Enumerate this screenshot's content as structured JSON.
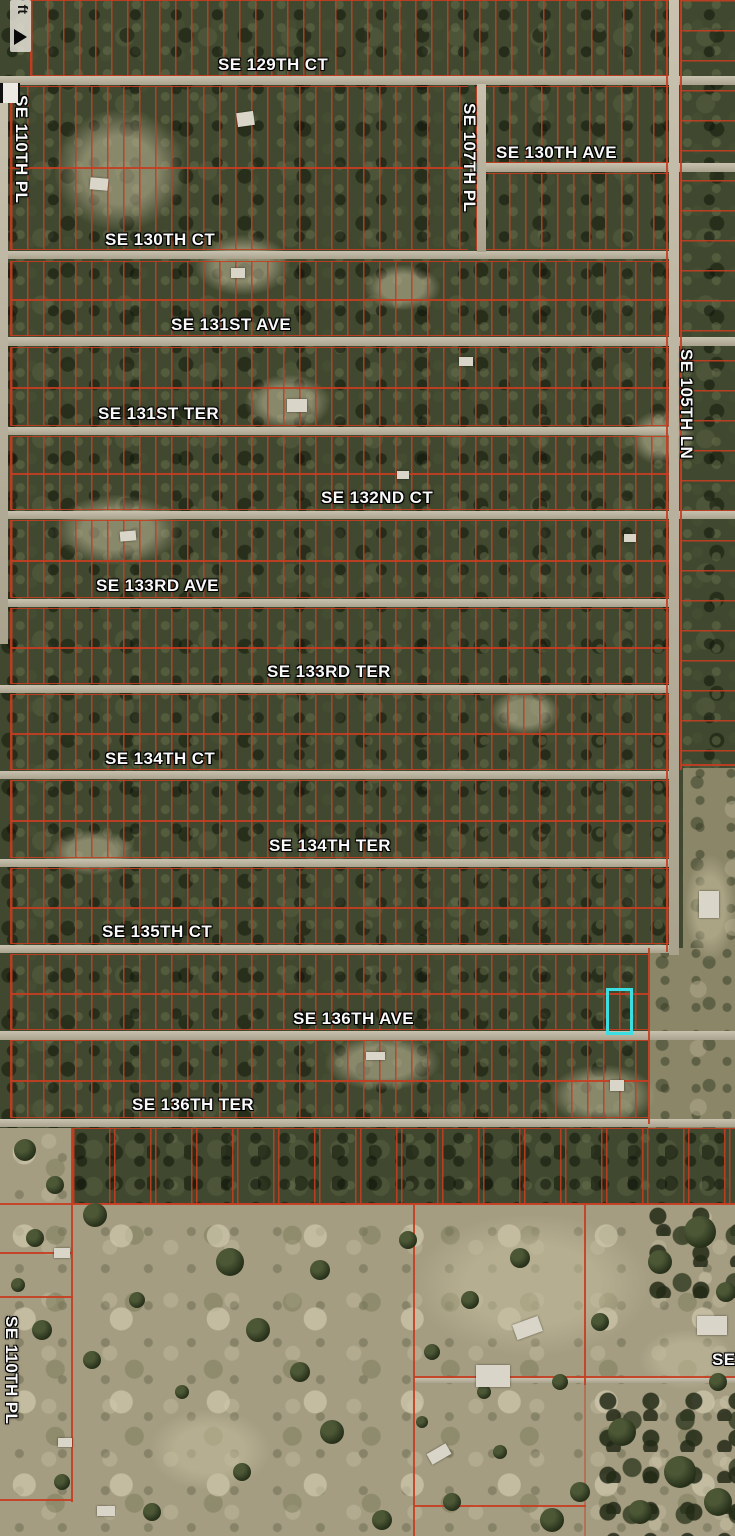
{
  "map": {
    "scale_label": "0 ft",
    "colors": {
      "parcel_line": "#c63d22",
      "road": "#bcb49d",
      "forest": "#40492f",
      "field": "#a59d82",
      "highlight": "#3bdfe2",
      "label_text": "#f8f8f8"
    },
    "street_labels": [
      {
        "text": "SE 129TH CT",
        "x": 218,
        "y": 55,
        "rot": 0
      },
      {
        "text": "SE 130TH AVE",
        "x": 496,
        "y": 143,
        "rot": 0
      },
      {
        "text": "SE 130TH CT",
        "x": 105,
        "y": 230,
        "rot": 0
      },
      {
        "text": "SE 131ST AVE",
        "x": 171,
        "y": 315,
        "rot": 0
      },
      {
        "text": "SE 131ST TER",
        "x": 98,
        "y": 404,
        "rot": 0
      },
      {
        "text": "SE 132ND CT",
        "x": 321,
        "y": 488,
        "rot": 0
      },
      {
        "text": "SE 133RD AVE",
        "x": 96,
        "y": 576,
        "rot": 0
      },
      {
        "text": "SE 133RD TER",
        "x": 267,
        "y": 662,
        "rot": 0
      },
      {
        "text": "SE 134TH CT",
        "x": 105,
        "y": 749,
        "rot": 0
      },
      {
        "text": "SE 134TH TER",
        "x": 269,
        "y": 836,
        "rot": 0
      },
      {
        "text": "SE 135TH CT",
        "x": 102,
        "y": 922,
        "rot": 0
      },
      {
        "text": "SE 136TH AVE",
        "x": 293,
        "y": 1009,
        "rot": 0
      },
      {
        "text": "SE 136TH TER",
        "x": 132,
        "y": 1095,
        "rot": 0
      },
      {
        "text": "SE 110TH PL",
        "x": 31,
        "y": 95,
        "rot": 90
      },
      {
        "text": "SE 107TH PL",
        "x": 479,
        "y": 103,
        "rot": 90
      },
      {
        "text": "SE 105TH LN",
        "x": 696,
        "y": 349,
        "rot": 90
      },
      {
        "text": "SE 110TH PL",
        "x": 21,
        "y": 1316,
        "rot": 90
      },
      {
        "text": "SE",
        "x": 712,
        "y": 1350,
        "rot": 0
      }
    ],
    "highlight_parcel": {
      "x": 606,
      "y": 988,
      "w": 21,
      "h": 41
    },
    "roads_h": [
      {
        "x": 0,
        "y": 76,
        "w": 735,
        "h": 9
      },
      {
        "x": 470,
        "y": 163,
        "w": 265,
        "h": 9
      },
      {
        "x": 0,
        "y": 251,
        "w": 678,
        "h": 8
      },
      {
        "x": 0,
        "y": 337,
        "w": 735,
        "h": 9
      },
      {
        "x": 0,
        "y": 427,
        "w": 678,
        "h": 8
      },
      {
        "x": 0,
        "y": 511,
        "w": 735,
        "h": 8
      },
      {
        "x": 0,
        "y": 599,
        "w": 678,
        "h": 8
      },
      {
        "x": 0,
        "y": 685,
        "w": 678,
        "h": 8
      },
      {
        "x": 0,
        "y": 771,
        "w": 678,
        "h": 8
      },
      {
        "x": 0,
        "y": 859,
        "w": 678,
        "h": 8
      },
      {
        "x": 0,
        "y": 945,
        "w": 678,
        "h": 8
      },
      {
        "x": 0,
        "y": 1031,
        "w": 735,
        "h": 9
      },
      {
        "x": 0,
        "y": 1119,
        "w": 735,
        "h": 8
      },
      {
        "x": 414,
        "y": 1378,
        "w": 321,
        "h": 5
      }
    ],
    "roads_v": [
      {
        "x": 0,
        "y": 84,
        "w": 8,
        "h": 560
      },
      {
        "x": 477,
        "y": 84,
        "w": 9,
        "h": 168
      },
      {
        "x": 669,
        "y": 0,
        "w": 10,
        "h": 955
      }
    ],
    "blocks": [
      {
        "x": 30,
        "y": 0,
        "w": 642,
        "h": 76,
        "pitch": 16
      },
      {
        "x": 10,
        "y": 86,
        "w": 458,
        "h": 164,
        "pitch": 16,
        "mid": 80
      },
      {
        "x": 476,
        "y": 86,
        "w": 196,
        "h": 77,
        "pitch": 16
      },
      {
        "x": 476,
        "y": 173,
        "w": 196,
        "h": 77,
        "pitch": 16
      },
      {
        "x": 10,
        "y": 261,
        "w": 662,
        "h": 75,
        "pitch": 16,
        "mid": 37
      },
      {
        "x": 10,
        "y": 347,
        "w": 662,
        "h": 79,
        "pitch": 16,
        "mid": 39
      },
      {
        "x": 10,
        "y": 436,
        "w": 662,
        "h": 74,
        "pitch": 16,
        "mid": 36
      },
      {
        "x": 10,
        "y": 520,
        "w": 662,
        "h": 78,
        "pitch": 16,
        "mid": 39
      },
      {
        "x": 10,
        "y": 608,
        "w": 662,
        "h": 76,
        "pitch": 16,
        "mid": 38
      },
      {
        "x": 10,
        "y": 694,
        "w": 662,
        "h": 76,
        "pitch": 16,
        "mid": 38
      },
      {
        "x": 10,
        "y": 780,
        "w": 662,
        "h": 78,
        "pitch": 16,
        "mid": 39
      },
      {
        "x": 10,
        "y": 868,
        "w": 662,
        "h": 76,
        "pitch": 16,
        "mid": 38
      },
      {
        "x": 10,
        "y": 954,
        "w": 638,
        "h": 76,
        "pitch": 16,
        "mid": 38
      },
      {
        "x": 10,
        "y": 1040,
        "w": 638,
        "h": 78,
        "pitch": 16,
        "mid": 39
      },
      {
        "x": 72,
        "y": 1128,
        "w": 663,
        "h": 76,
        "pitch": 36,
        "forest": true
      }
    ],
    "right_column": {
      "x": 681,
      "y": 0,
      "w": 54,
      "h": 768,
      "pitch": 30
    },
    "field_patches": [
      {
        "x": 683,
        "y": 768,
        "w": 52,
        "h": 360
      },
      {
        "x": 648,
        "y": 948,
        "w": 87,
        "h": 180
      }
    ],
    "boundary_lines": [
      {
        "x": 0,
        "y": 1203,
        "w": 735,
        "h": 2
      },
      {
        "x": 71,
        "y": 1128,
        "w": 2,
        "h": 374
      },
      {
        "x": 413,
        "y": 1205,
        "w": 2,
        "h": 331
      },
      {
        "x": 584,
        "y": 1205,
        "w": 2,
        "h": 180
      },
      {
        "x": 584,
        "y": 1385,
        "w": 2,
        "h": 151,
        "faint": true
      },
      {
        "x": 0,
        "y": 1252,
        "w": 73,
        "h": 2
      },
      {
        "x": 0,
        "y": 1296,
        "w": 73,
        "h": 2
      },
      {
        "x": 0,
        "y": 1499,
        "w": 73,
        "h": 2
      },
      {
        "x": 414,
        "y": 1505,
        "w": 172,
        "h": 2
      },
      {
        "x": 666,
        "y": 0,
        "w": 2,
        "h": 952
      },
      {
        "x": 680,
        "y": 0,
        "w": 2,
        "h": 770
      },
      {
        "x": 681,
        "y": 764,
        "w": 54,
        "h": 2
      },
      {
        "x": 648,
        "y": 948,
        "w": 2,
        "h": 176
      },
      {
        "x": 414,
        "y": 1376,
        "w": 321,
        "h": 2
      }
    ],
    "clearings": [
      {
        "x": 55,
        "y": 110,
        "w": 130,
        "h": 120
      },
      {
        "x": 195,
        "y": 235,
        "w": 95,
        "h": 60
      },
      {
        "x": 55,
        "y": 495,
        "w": 125,
        "h": 70
      },
      {
        "x": 245,
        "y": 375,
        "w": 85,
        "h": 55
      },
      {
        "x": 365,
        "y": 265,
        "w": 75,
        "h": 45
      },
      {
        "x": 325,
        "y": 1035,
        "w": 115,
        "h": 55
      },
      {
        "x": 550,
        "y": 1065,
        "w": 105,
        "h": 60
      },
      {
        "x": 50,
        "y": 830,
        "w": 85,
        "h": 45
      },
      {
        "x": 490,
        "y": 690,
        "w": 70,
        "h": 45
      },
      {
        "x": 630,
        "y": 410,
        "w": 65,
        "h": 55
      },
      {
        "x": 685,
        "y": 855,
        "w": 50,
        "h": 105
      },
      {
        "x": 415,
        "y": 1215,
        "w": 235,
        "h": 140
      },
      {
        "x": 640,
        "y": 1330,
        "w": 95,
        "h": 60
      },
      {
        "x": 150,
        "y": 1410,
        "w": 120,
        "h": 80
      }
    ],
    "dense_patches": [
      {
        "x": 595,
        "y": 1390,
        "w": 140,
        "h": 146
      },
      {
        "x": 645,
        "y": 1205,
        "w": 90,
        "h": 100
      }
    ],
    "trees": [
      {
        "x": 95,
        "y": 1215,
        "r": 12
      },
      {
        "x": 230,
        "y": 1262,
        "r": 14
      },
      {
        "x": 320,
        "y": 1270,
        "r": 10
      },
      {
        "x": 137,
        "y": 1300,
        "r": 8
      },
      {
        "x": 258,
        "y": 1330,
        "r": 12
      },
      {
        "x": 408,
        "y": 1240,
        "r": 9
      },
      {
        "x": 300,
        "y": 1372,
        "r": 10
      },
      {
        "x": 182,
        "y": 1392,
        "r": 7
      },
      {
        "x": 92,
        "y": 1360,
        "r": 9
      },
      {
        "x": 42,
        "y": 1330,
        "r": 10
      },
      {
        "x": 332,
        "y": 1432,
        "r": 12
      },
      {
        "x": 242,
        "y": 1472,
        "r": 9
      },
      {
        "x": 432,
        "y": 1352,
        "r": 8
      },
      {
        "x": 470,
        "y": 1300,
        "r": 9
      },
      {
        "x": 520,
        "y": 1258,
        "r": 10
      },
      {
        "x": 700,
        "y": 1232,
        "r": 16
      },
      {
        "x": 660,
        "y": 1262,
        "r": 12
      },
      {
        "x": 726,
        "y": 1292,
        "r": 10
      },
      {
        "x": 600,
        "y": 1322,
        "r": 9
      },
      {
        "x": 560,
        "y": 1382,
        "r": 8
      },
      {
        "x": 622,
        "y": 1432,
        "r": 14
      },
      {
        "x": 680,
        "y": 1472,
        "r": 16
      },
      {
        "x": 718,
        "y": 1502,
        "r": 14
      },
      {
        "x": 640,
        "y": 1512,
        "r": 12
      },
      {
        "x": 580,
        "y": 1492,
        "r": 10
      },
      {
        "x": 452,
        "y": 1502,
        "r": 9
      },
      {
        "x": 500,
        "y": 1452,
        "r": 7
      },
      {
        "x": 382,
        "y": 1520,
        "r": 10
      },
      {
        "x": 62,
        "y": 1482,
        "r": 8
      },
      {
        "x": 152,
        "y": 1512,
        "r": 9
      },
      {
        "x": 718,
        "y": 1382,
        "r": 9
      },
      {
        "x": 422,
        "y": 1422,
        "r": 6
      },
      {
        "x": 552,
        "y": 1520,
        "r": 12
      },
      {
        "x": 484,
        "y": 1392,
        "r": 7
      },
      {
        "x": 35,
        "y": 1238,
        "r": 9
      },
      {
        "x": 18,
        "y": 1285,
        "r": 7
      },
      {
        "x": 25,
        "y": 1150,
        "r": 11
      },
      {
        "x": 55,
        "y": 1185,
        "r": 9
      }
    ],
    "buildings": [
      {
        "x": 237,
        "y": 112,
        "w": 17,
        "h": 14,
        "r": -8
      },
      {
        "x": 90,
        "y": 178,
        "w": 18,
        "h": 12,
        "r": 5
      },
      {
        "x": 231,
        "y": 268,
        "w": 14,
        "h": 10,
        "r": 0
      },
      {
        "x": 287,
        "y": 399,
        "w": 20,
        "h": 13,
        "r": 0
      },
      {
        "x": 459,
        "y": 357,
        "w": 14,
        "h": 9,
        "r": 0
      },
      {
        "x": 120,
        "y": 531,
        "w": 16,
        "h": 10,
        "r": -5
      },
      {
        "x": 624,
        "y": 534,
        "w": 12,
        "h": 8,
        "r": 0
      },
      {
        "x": 397,
        "y": 471,
        "w": 12,
        "h": 8,
        "r": 0
      },
      {
        "x": 366,
        "y": 1052,
        "w": 19,
        "h": 8,
        "r": 0
      },
      {
        "x": 610,
        "y": 1080,
        "w": 14,
        "h": 11,
        "r": 0
      },
      {
        "x": 699,
        "y": 891,
        "w": 20,
        "h": 27,
        "r": 0
      },
      {
        "x": 514,
        "y": 1320,
        "w": 27,
        "h": 16,
        "r": -20
      },
      {
        "x": 476,
        "y": 1365,
        "w": 34,
        "h": 22,
        "r": 0
      },
      {
        "x": 428,
        "y": 1448,
        "w": 22,
        "h": 12,
        "r": -30
      },
      {
        "x": 697,
        "y": 1316,
        "w": 30,
        "h": 19,
        "r": 0
      },
      {
        "x": 54,
        "y": 1248,
        "w": 16,
        "h": 10,
        "r": 0
      },
      {
        "x": 58,
        "y": 1438,
        "w": 14,
        "h": 9,
        "r": 0
      },
      {
        "x": 97,
        "y": 1506,
        "w": 18,
        "h": 10,
        "r": 0
      }
    ]
  }
}
